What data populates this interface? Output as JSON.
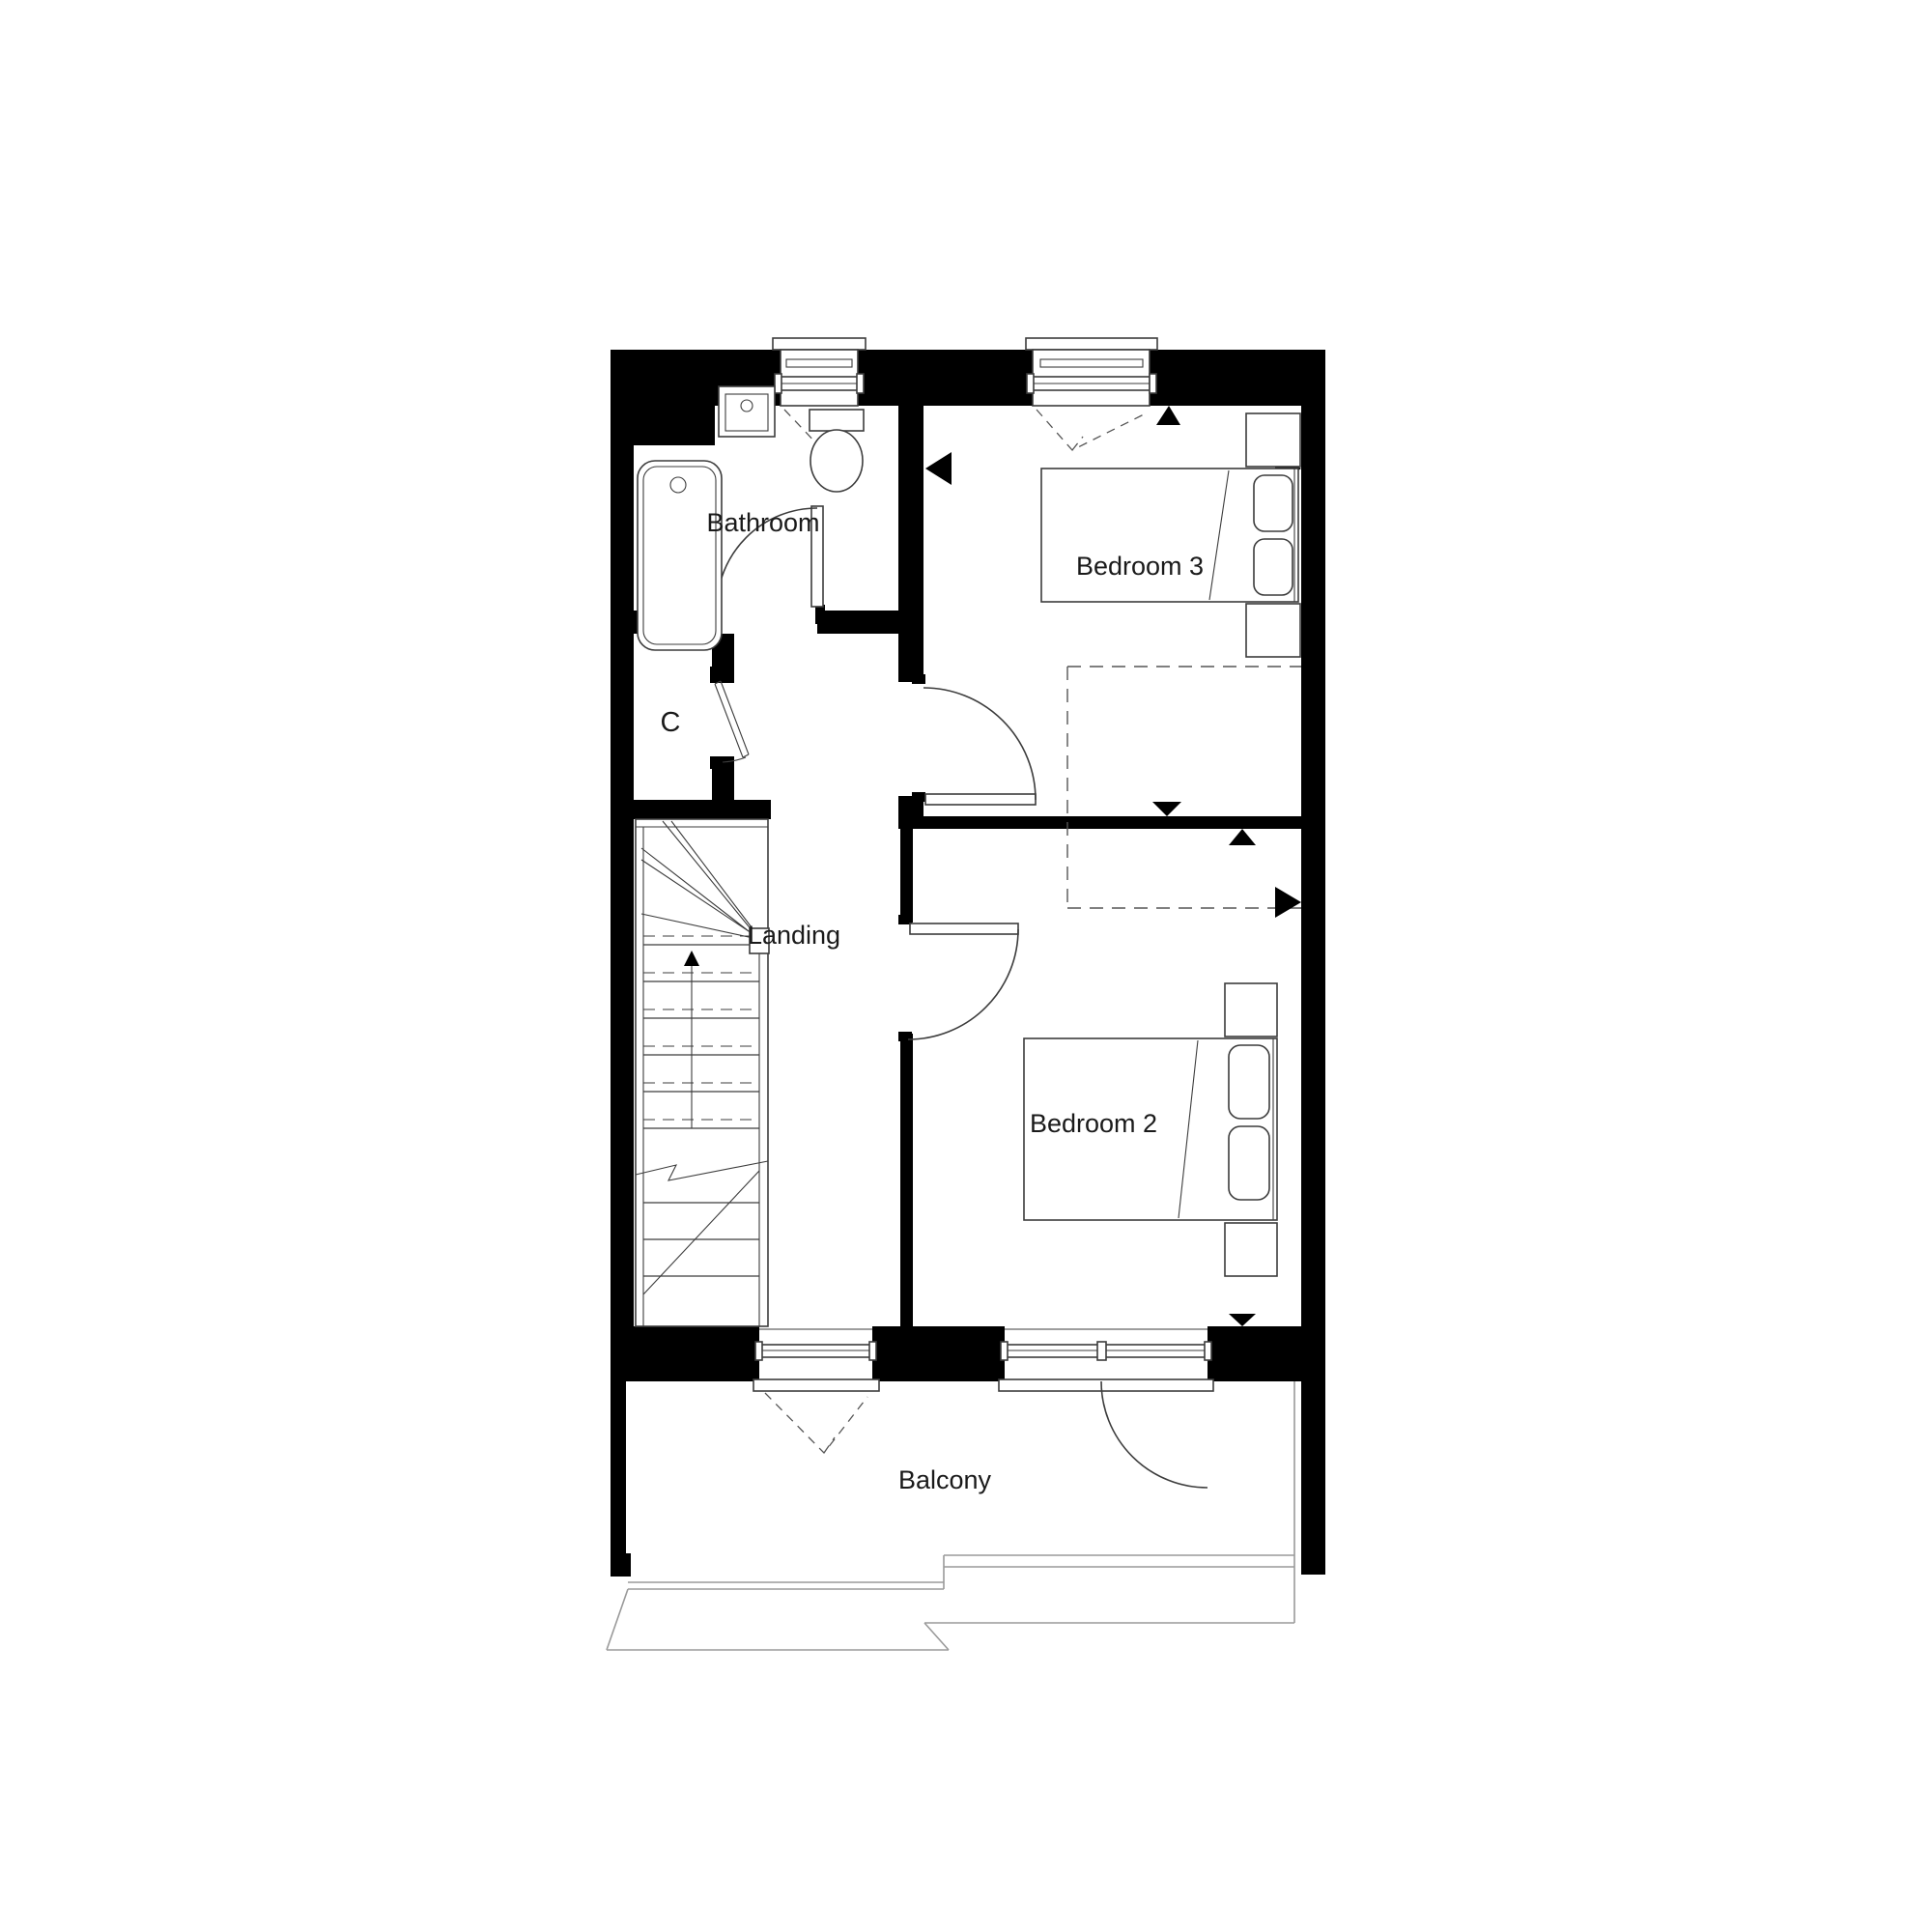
{
  "title": "First floor plan",
  "rooms": {
    "bathroom": {
      "label": "Bathroom"
    },
    "cupboard": {
      "label": "C"
    },
    "landing": {
      "label": "Landing"
    },
    "bedroom3": {
      "label": "Bedroom 3"
    },
    "bedroom2": {
      "label": "Bedroom 2"
    },
    "balcony": {
      "label": "Balcony"
    }
  },
  "colors": {
    "wall": "#000000",
    "background": "#ffffff",
    "fixture_line": "#3c3c3c",
    "roof_line": "#9a9a9a",
    "dashed_line": "#555555",
    "text": "#1a1a1a"
  }
}
